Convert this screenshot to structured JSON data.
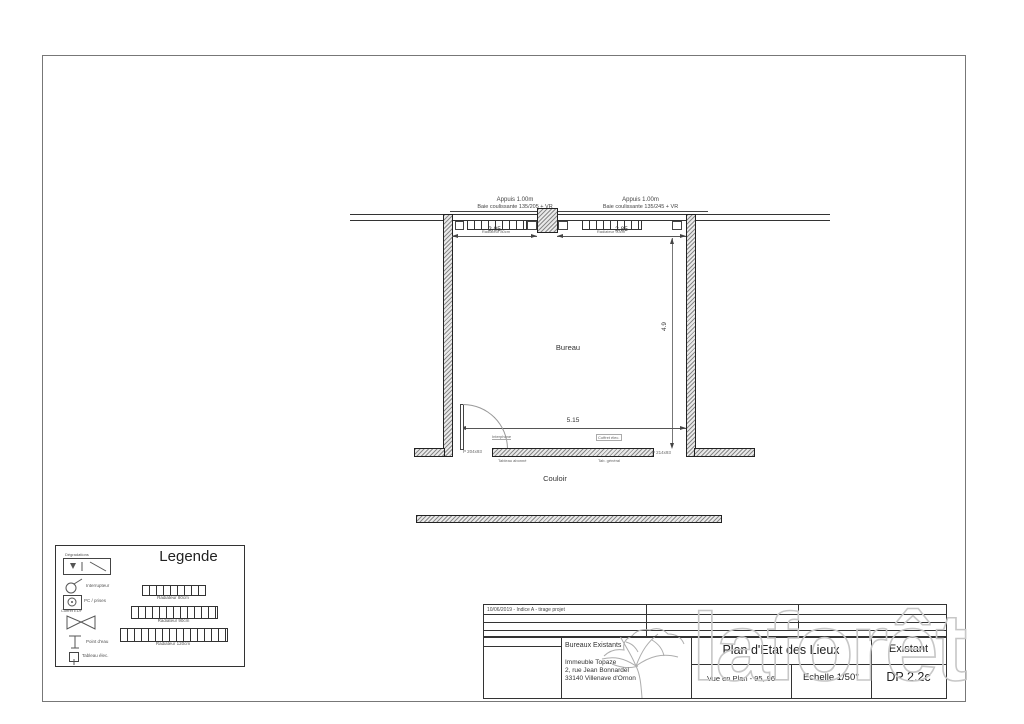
{
  "plan": {
    "room": "Bureau",
    "corridor": "Couloir",
    "window_left": {
      "sill": "Appuis 1.00m",
      "desc": "Baie coulissante 135/205 + VR",
      "dim": "2.05",
      "radiator": "Radiateur 80cm"
    },
    "window_right": {
      "sill": "Appuis 1.00m",
      "desc": "Baie coulissante 135/245 + VR",
      "dim": "2.85",
      "radiator": "Radiateur 90cm"
    },
    "dim_width": "5.15",
    "dim_height": "4.9",
    "door_left": "P 204x93",
    "door_right": "P 214x93",
    "note_interphone": "Interphone",
    "note_tableau": "Tableau abonné",
    "note_coffret": "Coffret élec.",
    "note_tge": "Tab. général"
  },
  "legend": {
    "title": "Legende",
    "items": [
      {
        "label": "Dégradations"
      },
      {
        "label": "Interrupteur"
      },
      {
        "label": "PC / prises"
      },
      {
        "label": "Coffret EDF"
      },
      {
        "label": "Point d'eau"
      },
      {
        "label": "Tableau élec."
      }
    ],
    "radiators": [
      {
        "label": "Radiateur 80cm"
      },
      {
        "label": "Radiateur 90cm"
      },
      {
        "label": "Radiateur 120cm"
      }
    ]
  },
  "titleblock": {
    "revision": "10/06/2019 - Indice A - tirage projet",
    "project": "Bureaux Existants",
    "address1": "Immeuble Topaze",
    "address2": "2, rue Jean Bonnardel",
    "address3": "33140 Villenave d'Ornon",
    "title": "Plan d'Etat des Lieux",
    "view": "Vue en Plan  - 95, 96",
    "scale": "Echelle 1/50°",
    "status": "Existant",
    "ref": "DP 2.2c"
  },
  "watermark": "laforêt"
}
